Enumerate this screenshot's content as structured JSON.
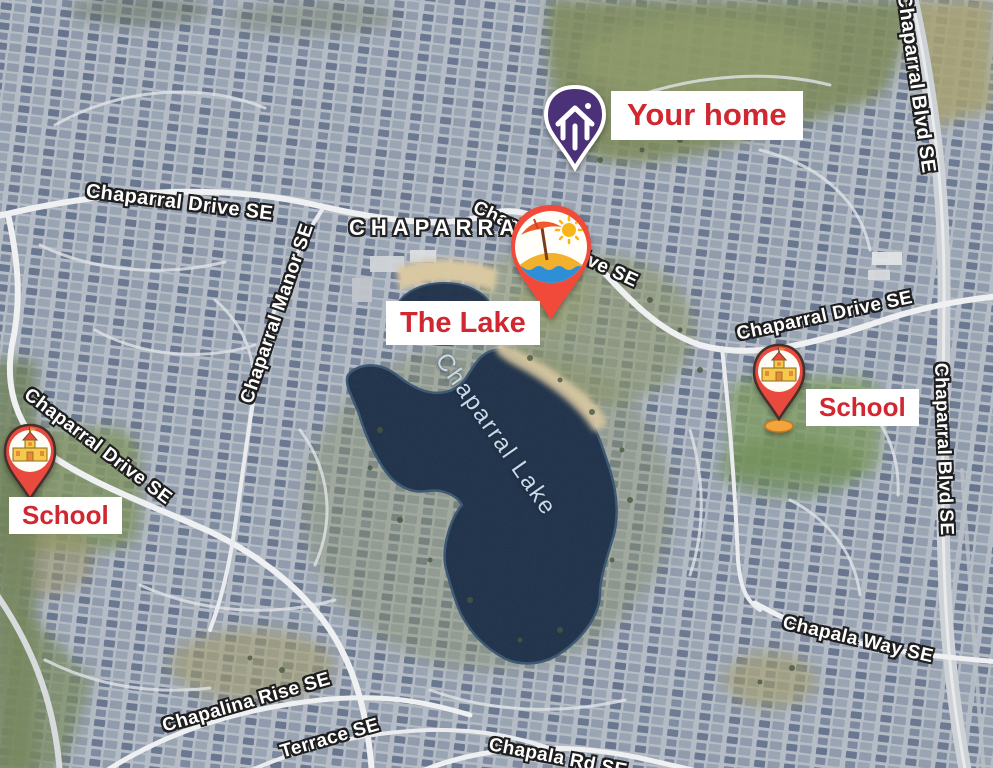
{
  "map": {
    "neighborhood_label": "CHAPARRAL",
    "lake_name": "Chaparral Lake",
    "streets": {
      "chaparral_drive": "Chaparral Drive SE",
      "chaparral_manor": "Chaparral Manor SE",
      "chaparral_blvd": "Chaparral Blvd SE",
      "chapala_way": "Chapala Way SE",
      "chapalina_rise": "Chapalina Rise SE",
      "terrace": "Terrace SE",
      "chapala_rd": "Chapala Rd SE"
    }
  },
  "markers": {
    "home": {
      "label": "Your home",
      "icon": "home-pin-icon",
      "pin_color": "#4b3178"
    },
    "lake": {
      "label": "The Lake",
      "icon": "beach-pin-icon",
      "pin_color": "#f14a3a"
    },
    "school_right": {
      "label": "School",
      "icon": "school-pin-icon",
      "pin_color": "#ea4a3e"
    },
    "school_left": {
      "label": "School",
      "icon": "school-pin-icon",
      "pin_color": "#ea4a3e"
    }
  },
  "colors": {
    "annotation_text_red": "#d02730",
    "annotation_bg": "#ffffff",
    "street_label_text": "#ffffff",
    "street_label_outline": "#1e1e1e",
    "lake_water": "#1e3049",
    "lake_label_blue": "#c9d9e8"
  }
}
